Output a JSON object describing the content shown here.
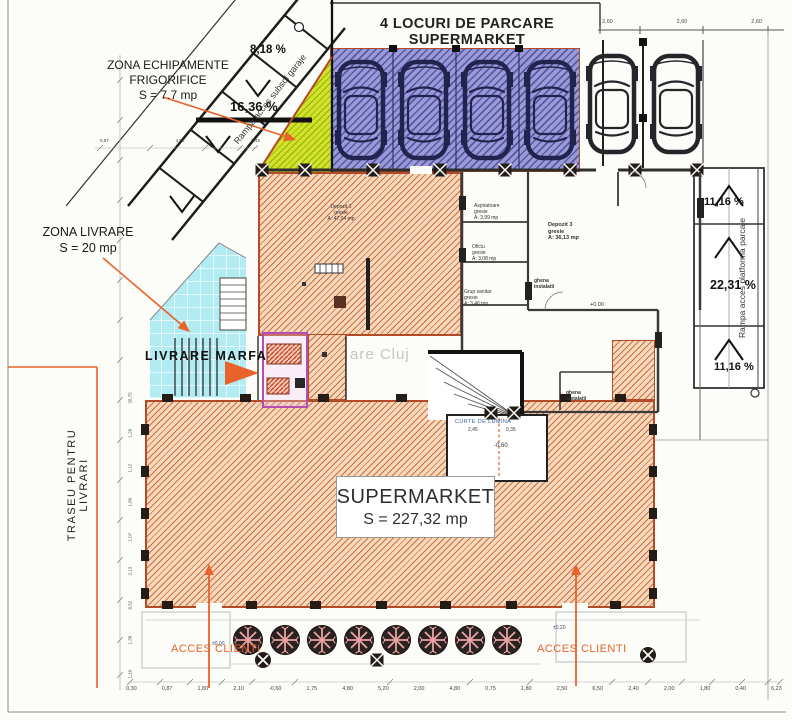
{
  "title": "4 LOCURI DE PARCARE SUPERMARKET",
  "annotations": {
    "zona_echipamente": {
      "l1": "ZONA ECHIPAMENTE",
      "l2": "FRIGORIFICE",
      "l3": "S = 7.7 mp"
    },
    "zona_livrare": {
      "l1": "ZONA LIVRARE",
      "l2": "S = 20 mp"
    },
    "livrare_marfa": "LIVRARE MARFA",
    "traseu_livrari": "TRASEU PENTRU LIVRARI",
    "acces_clienti_left": "ACCES CLIENTI",
    "acces_clienti_right": "ACCES CLIENTI",
    "watermark": "are Cluj"
  },
  "supermarket": {
    "name": "SUPERMARKET",
    "area": "S = 227,32 mp"
  },
  "ramps": {
    "garage": {
      "label": "Rampa acces subsol garaje",
      "slope_upper": "8,18 %",
      "slope_lower": "16,36 %"
    },
    "platform": {
      "label": "Rampa acces platforma parcaje",
      "slope_top": "11,16 %",
      "slope_mid": "22,31 %",
      "slope_bottom": "11,16 %"
    }
  },
  "rooms": {
    "depozit1": {
      "l1": "Depozit 1",
      "l2": "gresie",
      "l3": "A: 47,04 mp"
    },
    "depozit3": {
      "l1": "Depozit 3",
      "l2": "gresie",
      "l3": "A: 36,13 mp"
    },
    "aspiratoare": {
      "l1": "Aspiratoare",
      "l2": "gresie",
      "l3": "A: 3,99 mp"
    },
    "oficiu": {
      "l1": "Oficiu",
      "l2": "gresie",
      "l3": "A: 3,08 mp"
    },
    "grup_sanitar": {
      "l1": "Grup sanitar",
      "l2": "gresie",
      "l3": "A: 3,46 mp"
    },
    "ghena_1": {
      "l1": "ghena",
      "l2": "instalatii"
    },
    "ghena_2": {
      "l1": "ghena",
      "l2": "instalatii"
    },
    "curte": {
      "name": "CURTE DE LUMINA",
      "dim1": "2,45",
      "dim2": "0,35",
      "level": "-0.60"
    }
  },
  "levels": {
    "zero": "±0.00",
    "plus": "+0.00",
    "plus20": "±0.20"
  },
  "dims": {
    "top": [
      "2,60",
      "2,60",
      "2,60"
    ],
    "upper": [
      "0,57",
      "4,80",
      "0,45"
    ],
    "left": [
      "28,75",
      "1,26",
      "1,12",
      "1,80",
      "1,07",
      "2,13",
      "8,52",
      "1,38",
      "1,10"
    ],
    "bottom": [
      "0,30",
      "0,87",
      "1,80",
      "2,10",
      "-0,60",
      "1,75",
      "4,80",
      "5,20",
      "2,00",
      "4,80",
      "0,75",
      "1,80",
      "2,50",
      "6,50",
      "2,40",
      "2,00",
      "1,80",
      "0,40",
      "6,23"
    ]
  }
}
